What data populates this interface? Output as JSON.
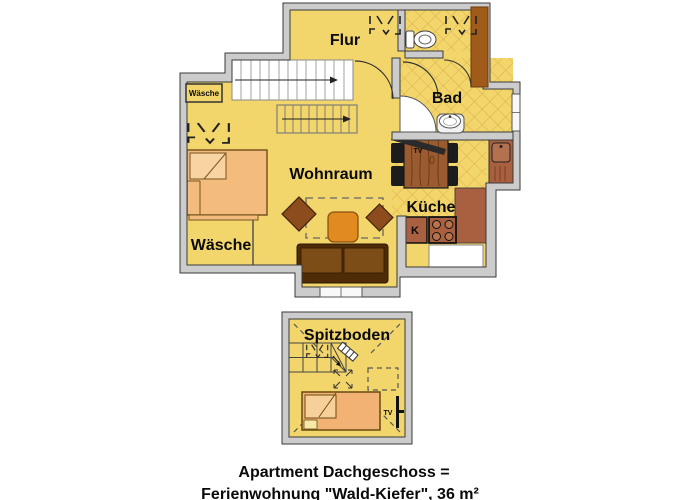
{
  "upper_floor": {
    "room_labels": {
      "flur": "Flur",
      "bad": "Bad",
      "wohnraum": "Wohnraum",
      "kueche": "Küche",
      "waesche": "Wäsche"
    },
    "annotations": {
      "laundry_closet": "Wäsche",
      "fridge": "K",
      "tv": "TV"
    }
  },
  "attic": {
    "room_label": "Spitzboden",
    "tv": "TV"
  },
  "caption": {
    "line1": "Apartment Dachgeschoss =",
    "line2": "Ferienwohnung \"Wald-Kiefer\", 36 m²"
  },
  "colors": {
    "floor_yellow": "#f2d66b",
    "tile_line": "#dcae49",
    "wall_gray": "#cccccc",
    "wall_outline": "#3a3a3a",
    "furniture_tan": "#f4bc7c",
    "sofa_dark_brown": "#4f2b07",
    "sofa_cushion": "#7d4d18",
    "table_orange": "#e18a20",
    "chair_brown": "#8c4c1d",
    "wood_table": "#9b5b31",
    "counter_terracotta": "#a86040",
    "chimney_brown": "#a05a1a",
    "stairs_white": "#ffffff",
    "text_black": "#0a0a0a"
  },
  "icons": {
    "skylight-window-icon": "dashed roof-window symbol",
    "toilet-icon": "cistern + oval bowl",
    "washbasin-icon": "round basin on pedestal",
    "kitchen-sink-icon": "inset basin with faucet dot",
    "stove-icon": "square with 4 burner rings",
    "tv-mount-icon": "diagonal dark bar / wall bar",
    "stair-arrow-icon": "direction-of-climb arrow",
    "door-swing-icon": "quarter-circle arc",
    "window-icon": "white band in wall with ticks"
  }
}
